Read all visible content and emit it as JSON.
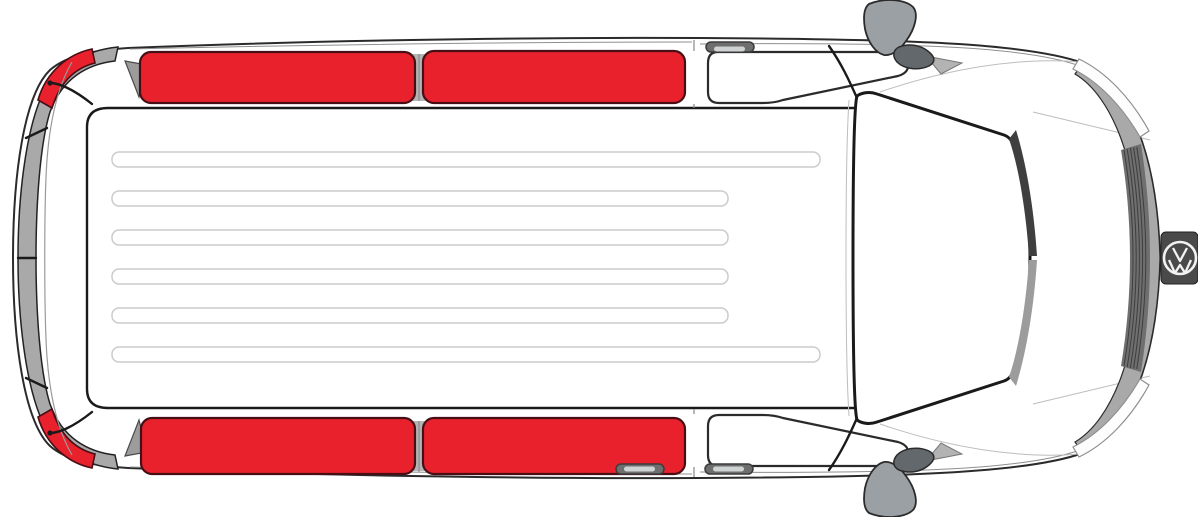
{
  "diagram": {
    "type": "vehicle-top-view",
    "subject": "van",
    "view": "top-down plan view, front facing right",
    "logo_monogram": "VW",
    "highlight_meaning": "window panels shown highlighted in red",
    "highlighted_panels": [
      "rear-window-left-corner-shade",
      "rear-window-right-corner-shade",
      "left-rear-side-window",
      "left-middle-side-window",
      "right-rear-side-window",
      "right-middle-side-window"
    ],
    "unhighlighted_windows": [
      "left-front-door-window",
      "right-front-door-window",
      "windshield"
    ],
    "roof_rib_count": 6,
    "door_handle_count": 3,
    "mirror_count": 2,
    "colors": {
      "body_fill": "#ffffff",
      "outline": "#2b2b2b",
      "highlight_red": "#e8212d",
      "highlight_stroke": "#470f15",
      "band_gray": "#a9a9a9",
      "gap_gray": "#b4b4b4",
      "vent_gray": "#9c9c9c",
      "mirror_gray": "#9aa0a4",
      "mirror_dark": "#63686c",
      "mirror_wedge": "#b3b3b3",
      "handle_gray": "#6e6e6e",
      "handle_inner": "#cfd3d3",
      "grille_dark": "#6f6f6f",
      "wiper_dark": "#3f3f3f",
      "wiper_light": "#9c9c9c",
      "headlight_fill": "#fdfdfd",
      "logo_patch": "#4a4a4a",
      "logo_ink": "#f2f2f2"
    }
  }
}
